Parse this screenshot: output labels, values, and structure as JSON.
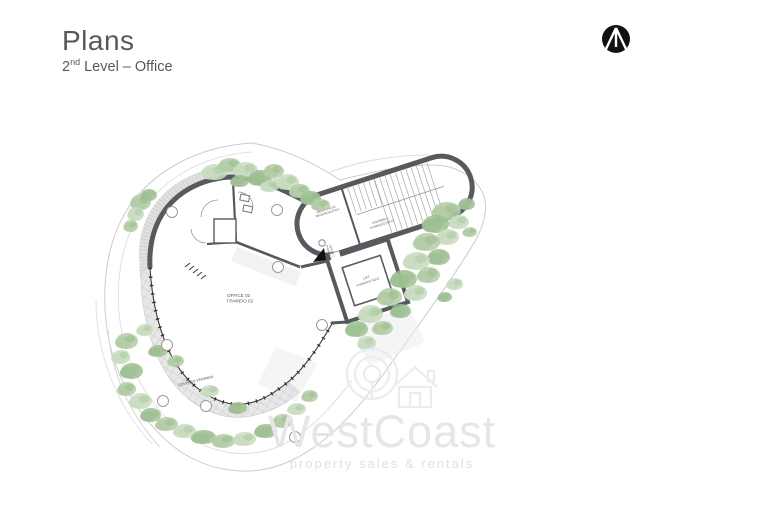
{
  "header": {
    "title": "Plans",
    "level_number": "2",
    "level_ordinal": "nd",
    "level_rest": " Level – Office"
  },
  "watermark": {
    "brand": "WestCoast",
    "tagline": "property sales & rentals"
  },
  "plan": {
    "rooms": {
      "office": {
        "en": "OFFICE 02",
        "gr": "ΓΡΑΦΕΙΟ 02"
      },
      "mechanical": {
        "en": "MECHANICAL",
        "gr": "ΜΗΧΑΝΟΛΟΓΙΚΑ"
      },
      "stairwell": {
        "en": "STAIRWELL",
        "gr": "ΚΛΙΜΑΚΟΣΤΑΣΙΟ"
      },
      "lift": {
        "en": "LIFT",
        "gr": "ΚΛΙΜΑΚΟΣΤΑΣΙΟ"
      },
      "veranda": {
        "en": "COVERED VERANDA"
      },
      "entry": {
        "en": "OFFICE 2",
        "gr": "ΓΡΑΦΕΙΟ 2"
      }
    }
  },
  "colors": {
    "title_text": "#55585c",
    "wall": "#565a5f",
    "glass": "#3a3a3a",
    "hatch_fill": "#e7e7e7",
    "hatch_line": "#c2c2c2",
    "site_outline": "#cccccc",
    "foliage_light": "#c9dcbf",
    "foliage_mid": "#b3cda6",
    "foliage_dark": "#9fc093",
    "watermark": "#e6e6e6",
    "logo_black": "#111111"
  }
}
